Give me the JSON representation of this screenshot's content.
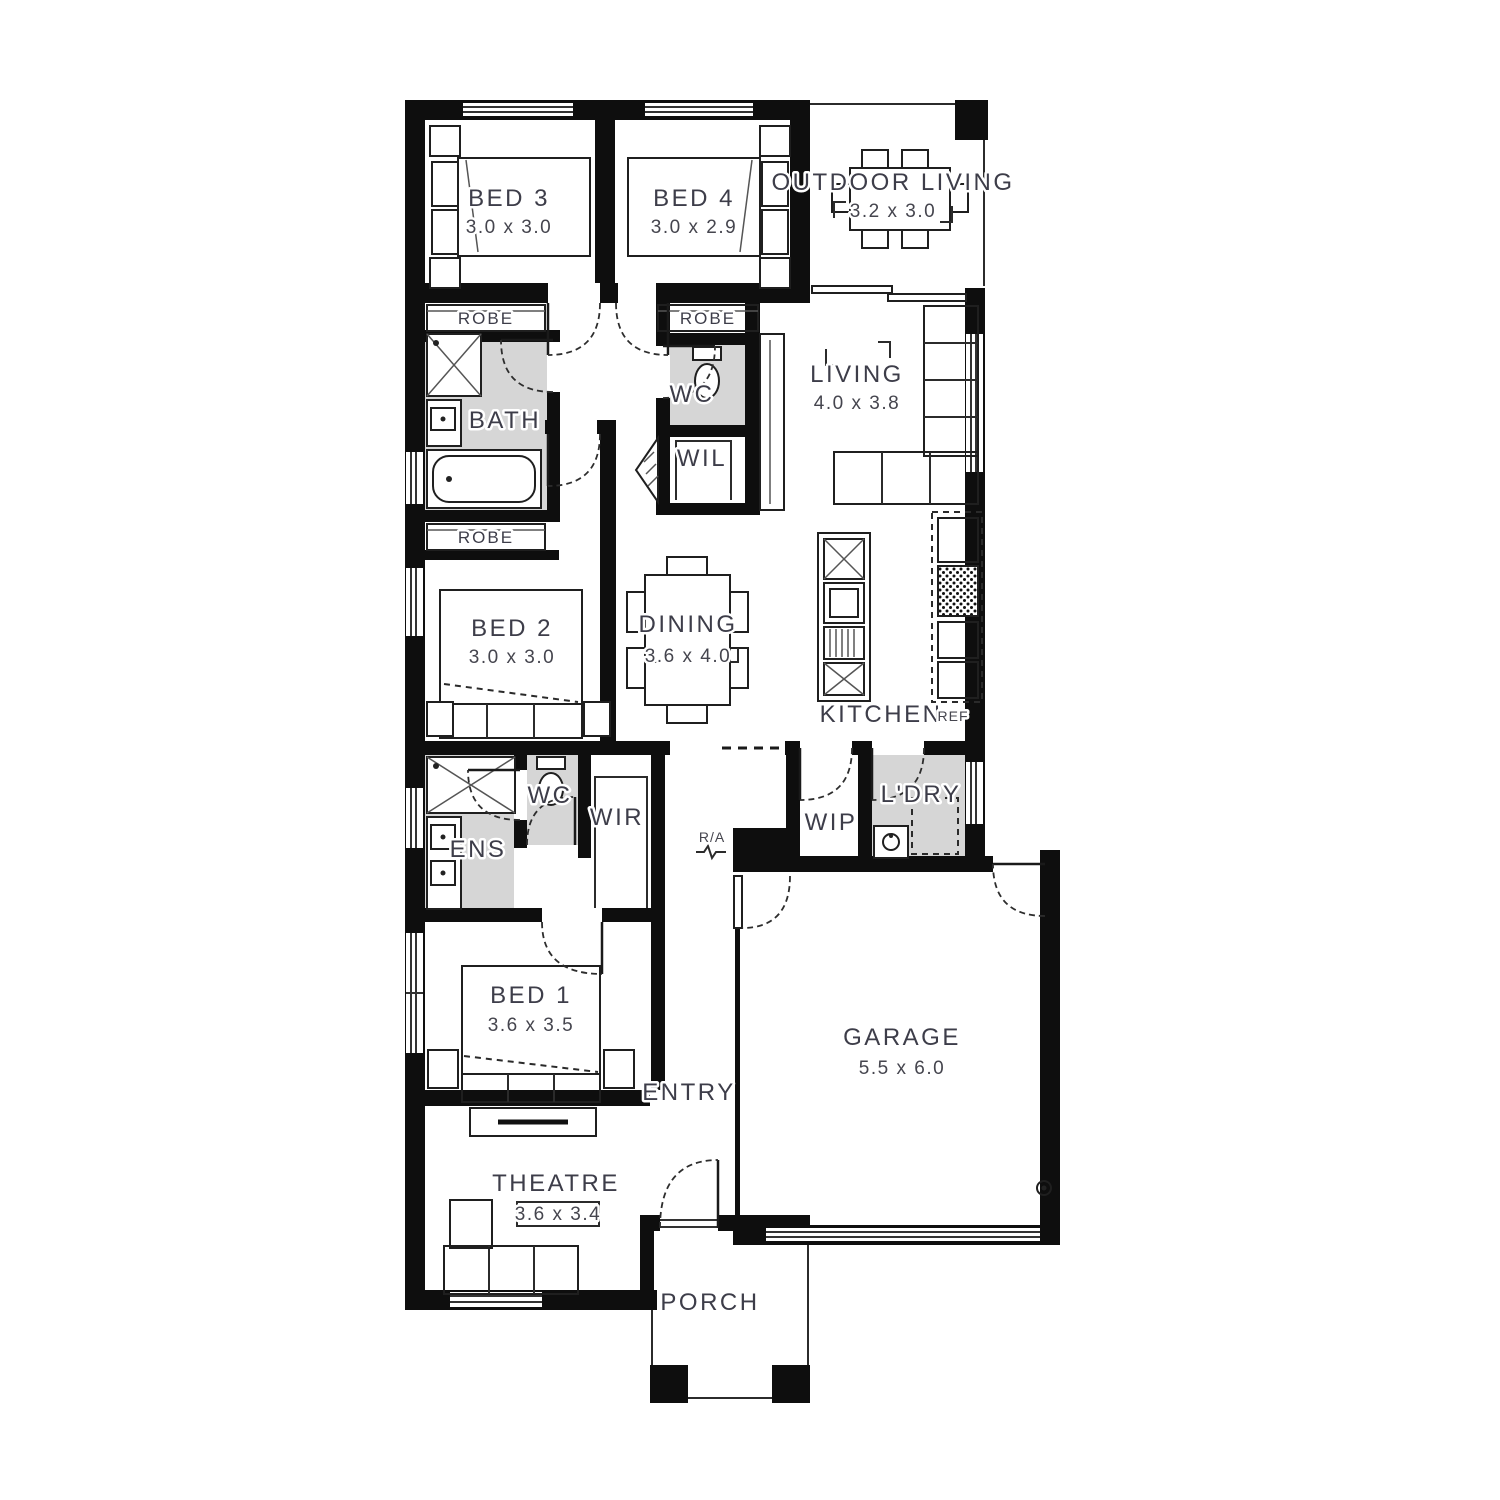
{
  "title": "House floor plan",
  "colors": {
    "wall": "#0e0e0e",
    "wet_area": "#d6d6d6",
    "label": "#3d3d49",
    "background": "#ffffff"
  },
  "rooms": {
    "bed3": {
      "name": "BED 3",
      "dims": "3.0 x 3.0"
    },
    "bed4": {
      "name": "BED 4",
      "dims": "3.0 x 2.9"
    },
    "outdoor": {
      "name": "OUTDOOR LIVING",
      "dims": "3.2 x 3.0"
    },
    "living": {
      "name": "LIVING",
      "dims": "4.0 x 3.8"
    },
    "bed2": {
      "name": "BED 2",
      "dims": "3.0 x 3.0"
    },
    "dining": {
      "name": "DINING",
      "dims": "3.6 x 4.0"
    },
    "kitchen": {
      "name": "KITCHEN"
    },
    "bed1": {
      "name": "BED 1",
      "dims": "3.6 x 3.5"
    },
    "garage": {
      "name": "GARAGE",
      "dims": "5.5 x 6.0"
    },
    "theatre": {
      "name": "THEATRE",
      "dims": "3.6 x 3.4"
    },
    "entry": {
      "name": "ENTRY"
    },
    "porch": {
      "name": "PORCH"
    },
    "bath": {
      "name": "BATH"
    },
    "ens": {
      "name": "ENS"
    },
    "wc_upper": {
      "name": "WC"
    },
    "wc_lower": {
      "name": "WC"
    },
    "wil": {
      "name": "WIL"
    },
    "wir": {
      "name": "WIR"
    },
    "wip": {
      "name": "WIP"
    },
    "laundry": {
      "name": "L'DRY"
    },
    "robe_bed3": {
      "name": "ROBE"
    },
    "robe_bed4": {
      "name": "ROBE"
    },
    "robe_bed2": {
      "name": "ROBE"
    }
  },
  "labels": {
    "fridge": "REF",
    "return_air": "R/A"
  }
}
